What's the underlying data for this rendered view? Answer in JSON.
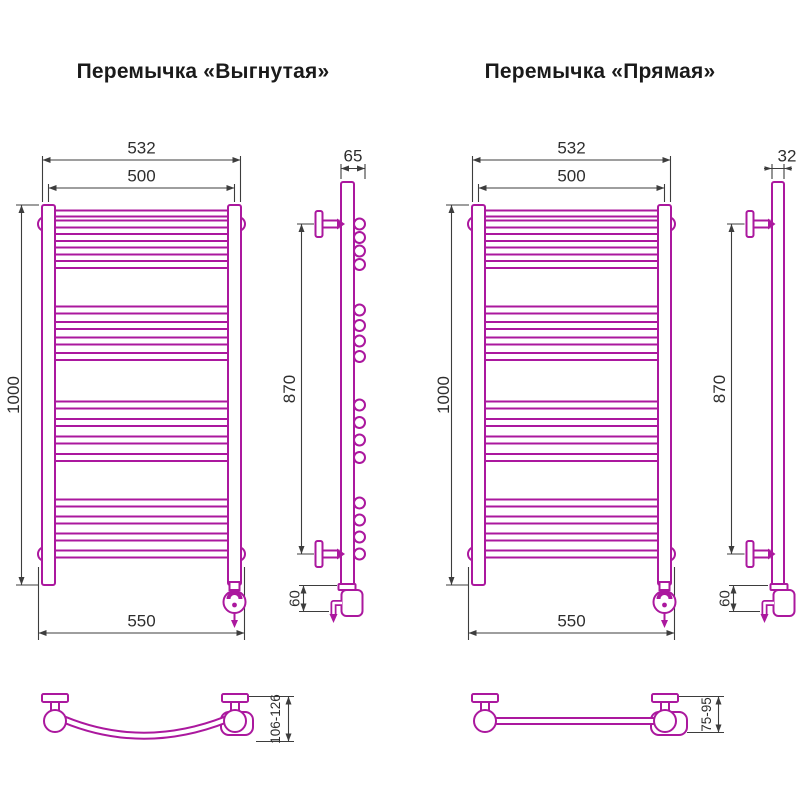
{
  "page": {
    "background": "#ffffff"
  },
  "colors": {
    "drawing": "#ab189e",
    "dimension": "#3d3d3d",
    "title_text": "#1a1a1a"
  },
  "models": {
    "curved": {
      "title": "Перемычка «Выгнутая»",
      "front": {
        "overall_width": "532",
        "axis_width": "500",
        "height": "1000",
        "mount_width": "550"
      },
      "side": {
        "depth": "65",
        "bracket_span": "870",
        "bottom_offset": "60"
      },
      "top_view": {
        "wall_distance": "106-126"
      },
      "rung_groups": [
        4,
        4,
        4,
        4
      ]
    },
    "straight": {
      "title": "Перемычка «Прямая»",
      "front": {
        "overall_width": "532",
        "axis_width": "500",
        "height": "1000",
        "mount_width": "550"
      },
      "side": {
        "depth": "32",
        "bracket_span": "870",
        "bottom_offset": "60"
      },
      "top_view": {
        "wall_distance": "75-95"
      },
      "rung_groups": [
        4,
        4,
        4,
        4
      ]
    }
  }
}
